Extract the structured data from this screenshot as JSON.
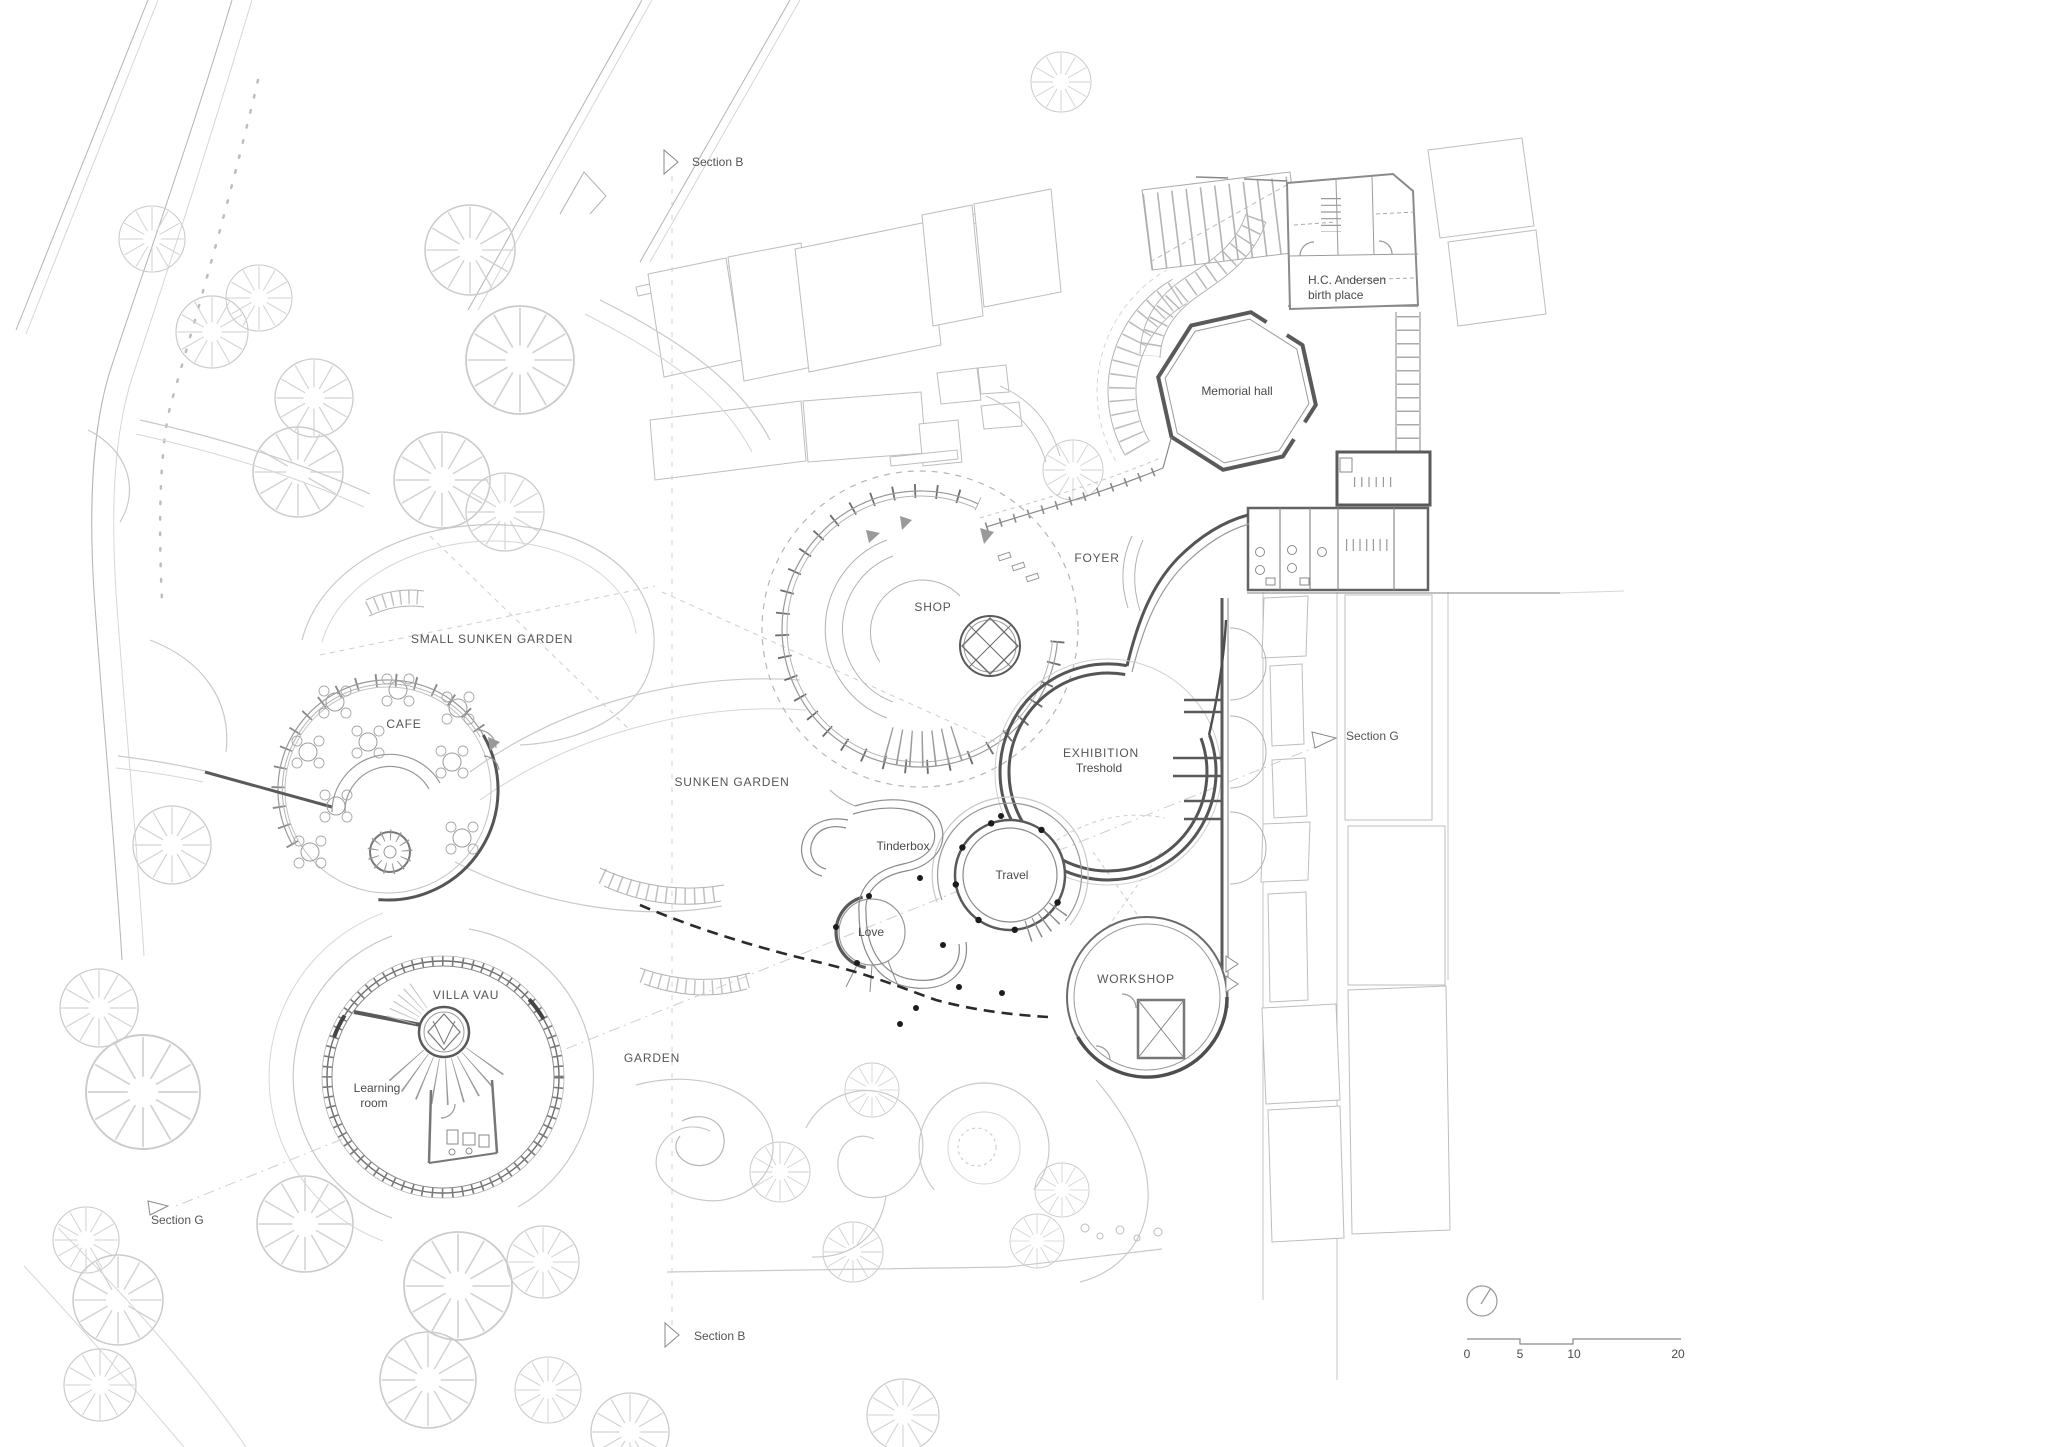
{
  "drawing": {
    "type": "architectural site plan",
    "paper_color": "#ffffff",
    "ink_dark": "#4a4a4a",
    "ink_light": "#c8c8c8"
  },
  "labels": {
    "section_b_top": "Section B",
    "section_b_bottom": "Section B",
    "section_g_right": "Section G",
    "section_g_left": "Section G",
    "birthplace_line1": "H.C. Andersen",
    "birthplace_line2": "birth place",
    "memorial_hall": "Memorial hall",
    "foyer": "FOYER",
    "shop": "SHOP",
    "small_sunken_garden": "SMALL SUNKEN GARDEN",
    "cafe": "CAFE",
    "exhibition_line1": "EXHIBITION",
    "exhibition_line2": "Treshold",
    "sunken_garden": "SUNKEN GARDEN",
    "tinderbox": "Tinderbox",
    "travel": "Travel",
    "love": "Love",
    "workshop": "WORKSHOP",
    "villa_vau": "VILLA VAU",
    "learning_line1": "Learning",
    "learning_line2": "room",
    "garden": "GARDEN"
  },
  "scale_bar": {
    "t0": "0",
    "t5": "5",
    "t10": "10",
    "t20": "20"
  }
}
